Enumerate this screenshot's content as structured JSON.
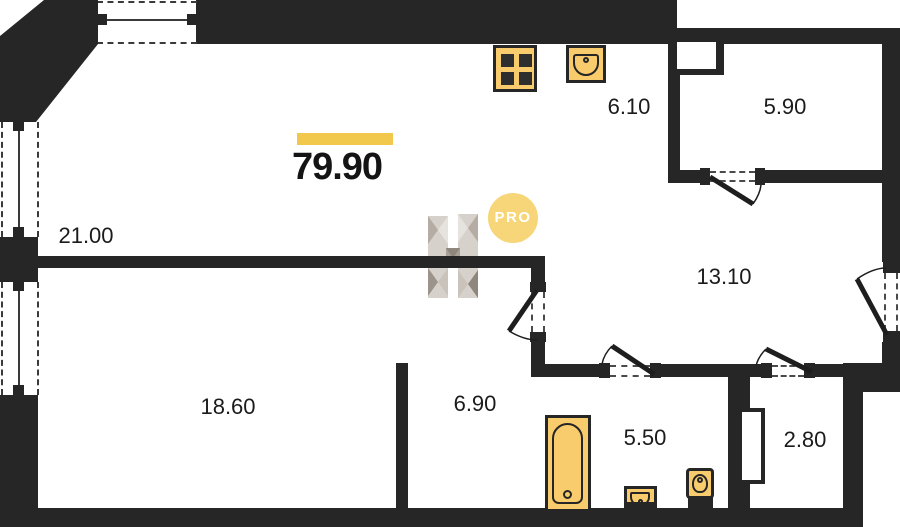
{
  "floor_plan": {
    "total_area": "79.90",
    "badge": "PRO",
    "rooms": [
      {
        "name": "living-room",
        "area": "21.00"
      },
      {
        "name": "kitchen",
        "area": "6.10"
      },
      {
        "name": "top-right-room",
        "area": "5.90"
      },
      {
        "name": "hallway",
        "area": "13.10"
      },
      {
        "name": "bedroom",
        "area": "18.60"
      },
      {
        "name": "corridor",
        "area": "6.90"
      },
      {
        "name": "bathroom",
        "area": "5.50"
      },
      {
        "name": "storage",
        "area": "2.80"
      }
    ],
    "fixtures": [
      "stove-icon",
      "kitchen-sink-icon",
      "bathtub-icon",
      "wash-basin-icon",
      "toilet-icon"
    ],
    "colors": {
      "wall": "#262626",
      "accent_yellow": "#F2C84C",
      "fixture_fill": "#F8CC6C",
      "badge_background": "#F6D678",
      "watermark_gray": "#C9C2BA"
    }
  }
}
